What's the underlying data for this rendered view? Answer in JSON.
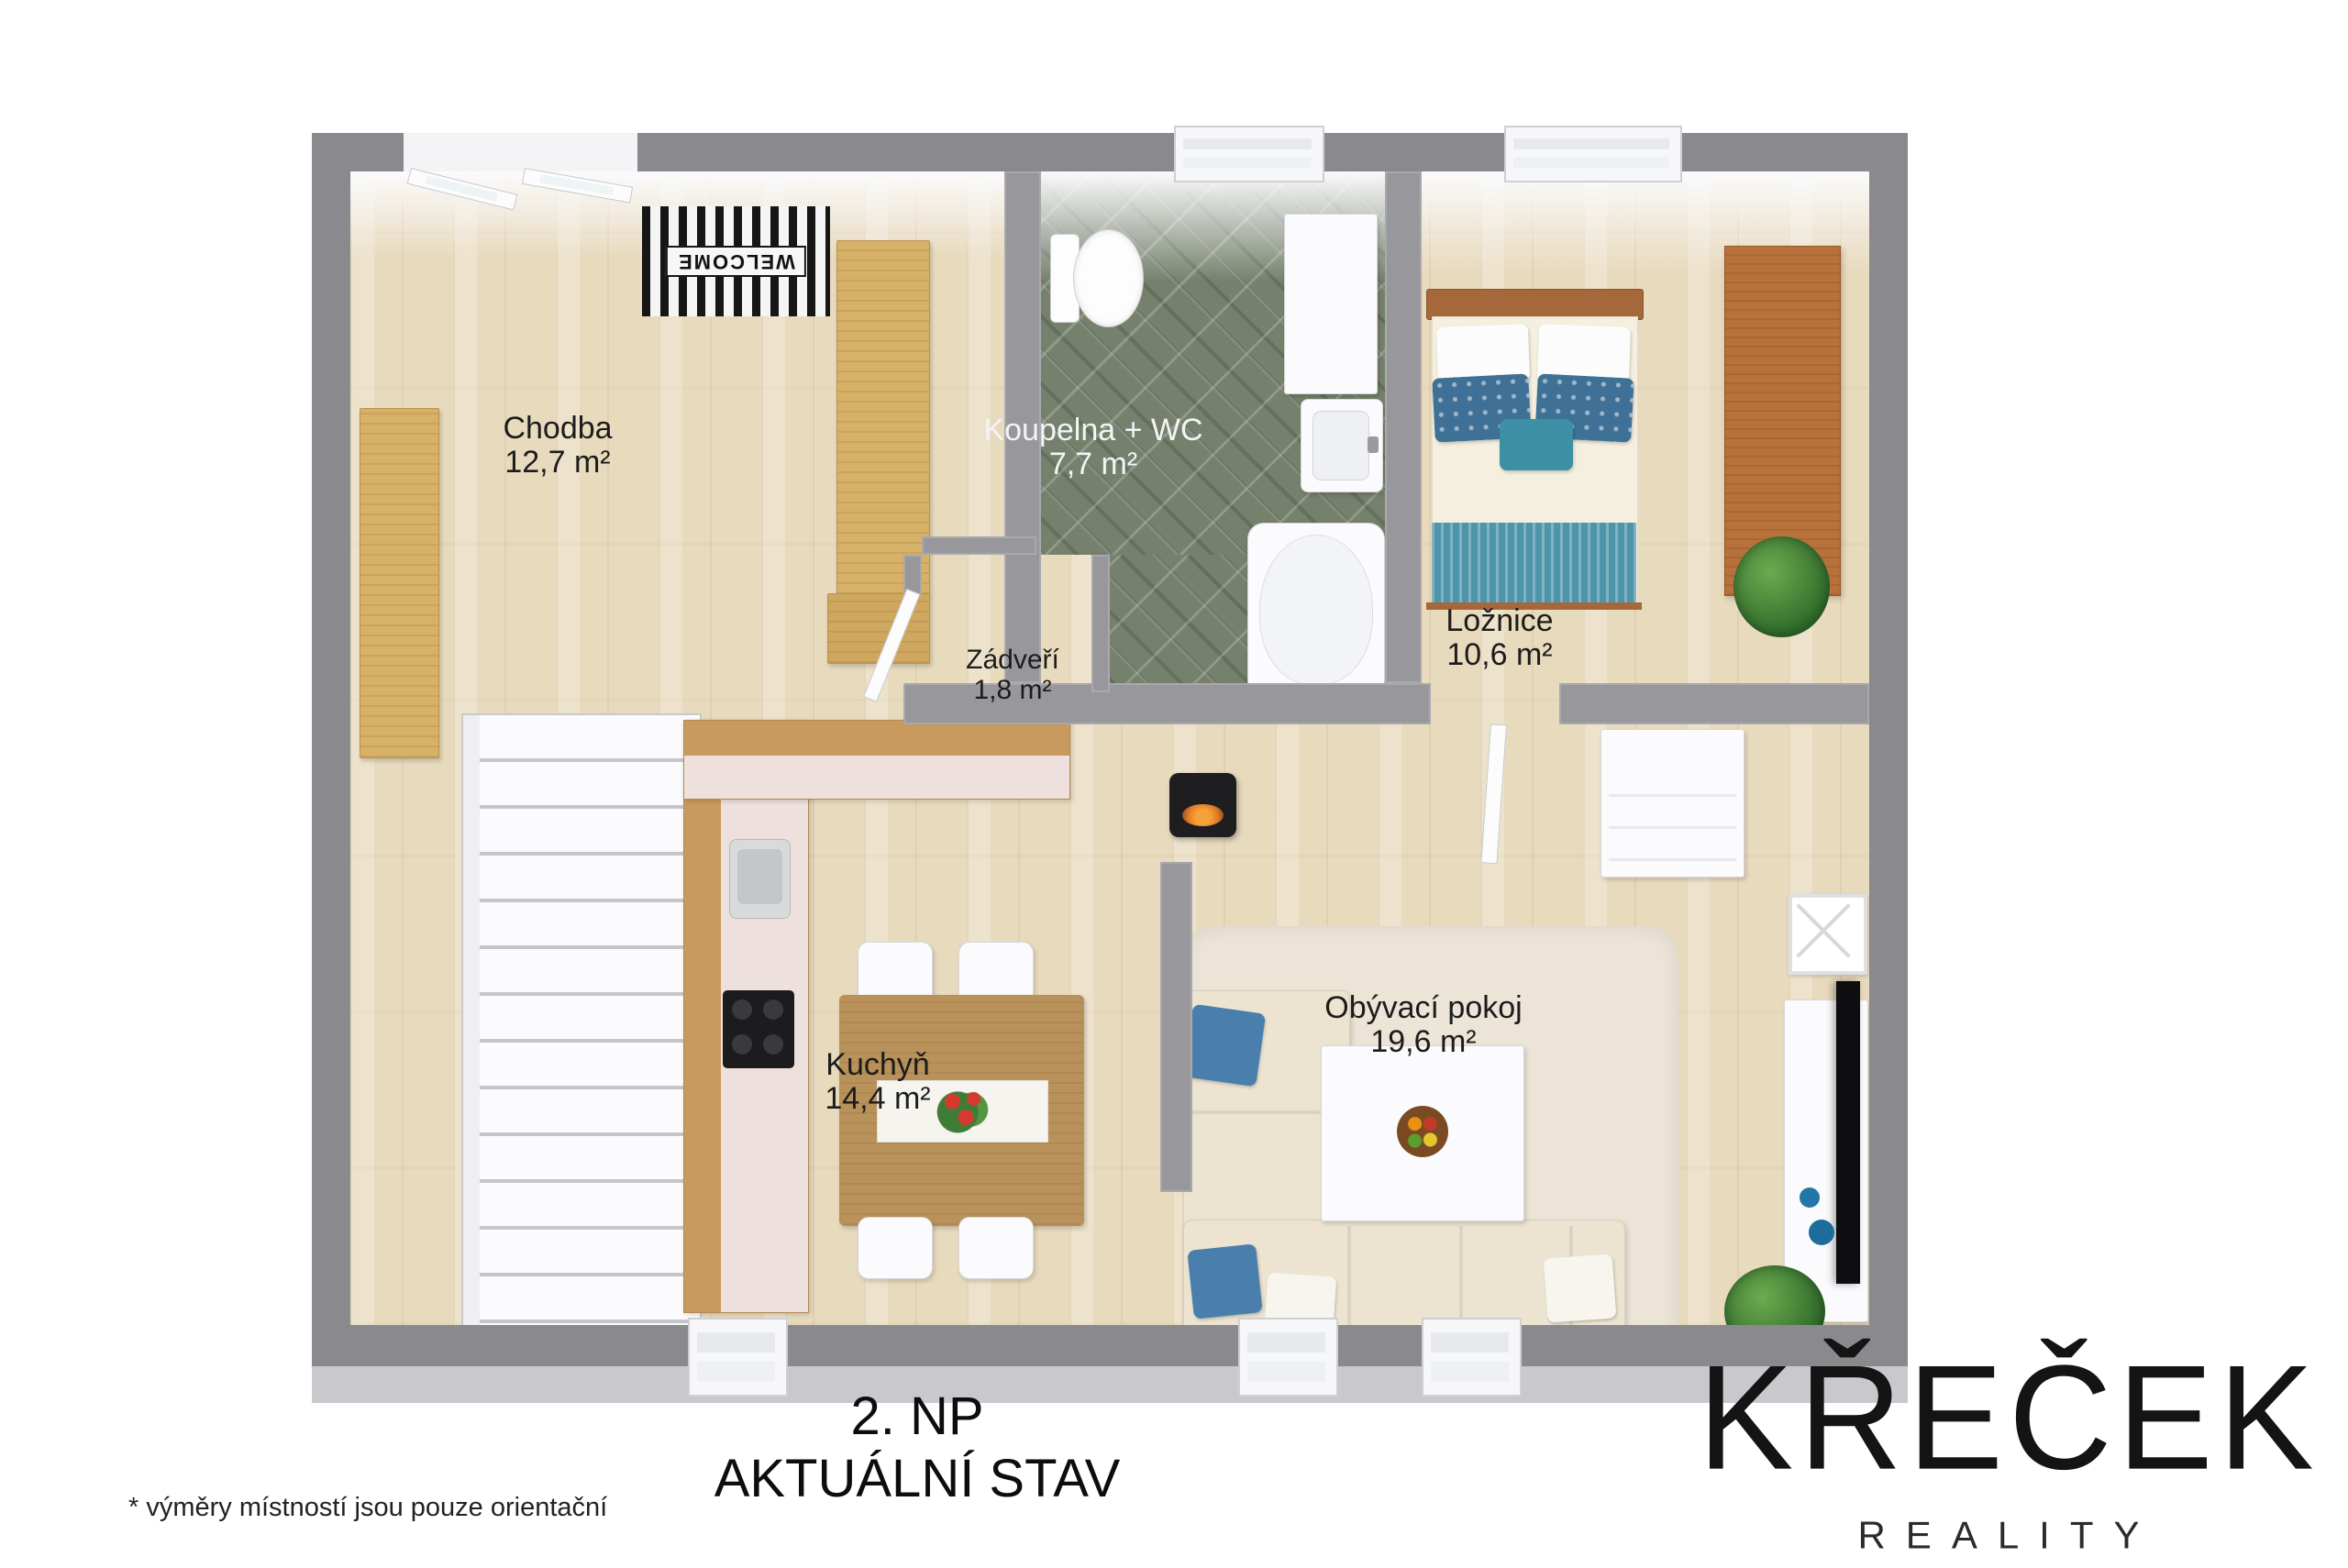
{
  "rooms": [
    {
      "name": "Chodba",
      "area": "12,7 m²"
    },
    {
      "name": "Koupelna + WC",
      "area": "7,7 m²"
    },
    {
      "name": "Ložnice",
      "area": "10,6 m²"
    },
    {
      "name": "Zádveří",
      "area": "1,8 m²"
    },
    {
      "name": "Kuchyň",
      "area": "14,4 m²"
    },
    {
      "name": "Obývací pokoj",
      "area": "19,6 m²"
    }
  ],
  "titles": {
    "floor": "2. NP",
    "state": "AKTUÁLNÍ STAV"
  },
  "footnote": "*  výměry místností jsou pouze orientační",
  "logo": {
    "brand": "KŘEČEK",
    "subtitle": "REALITY"
  },
  "decor": {
    "welcome_mat": "WELCOME"
  },
  "colors": {
    "wall": "#8a8a8e",
    "wall_face": "#c9c9cd",
    "wood_floor": "#e8dabd",
    "bath_tile_green": "#75816c",
    "cabinet_wood": "#d8b168",
    "bed_frame_wood": "#a4683a",
    "accent_teal": "#4f95a9",
    "accent_blue": "#4a7fad",
    "sofa_beige": "#ece4d1",
    "logo_black": "#141414"
  }
}
